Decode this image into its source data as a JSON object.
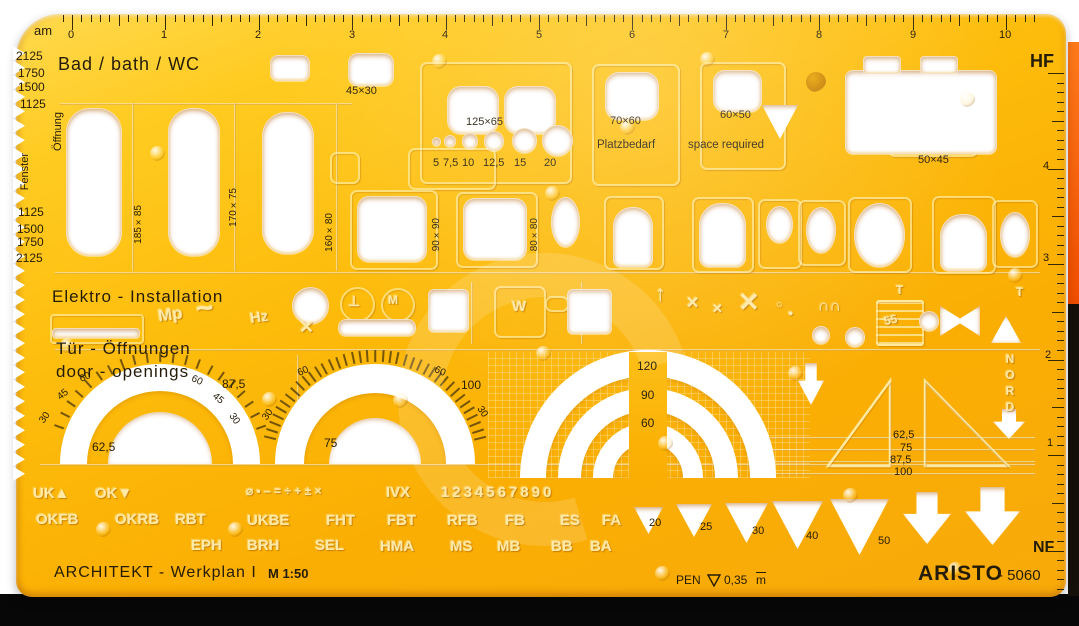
{
  "template": {
    "brand": "ARISTO",
    "model": "- 5060",
    "series_title": "ARCHITEKT - Werkplan I",
    "scale": "M 1:50",
    "pen_label": "PEN",
    "pen_size": "0,35",
    "pen_unit": "m",
    "corner_top_left": "am",
    "corner_top_right": "HF",
    "corner_bottom_right": "NF"
  },
  "top_ruler": {
    "numbers": [
      {
        "t": "0",
        "x": 68,
        "y": 30
      },
      {
        "t": "1",
        "x": 161,
        "y": 30
      },
      {
        "t": "2",
        "x": 255,
        "y": 30
      },
      {
        "t": "3",
        "x": 349,
        "y": 30
      },
      {
        "t": "4",
        "x": 442,
        "y": 30
      },
      {
        "t": "5",
        "x": 536,
        "y": 30
      },
      {
        "t": "6",
        "x": 629,
        "y": 30
      },
      {
        "t": "7",
        "x": 723,
        "y": 30
      },
      {
        "t": "8",
        "x": 816,
        "y": 30
      },
      {
        "t": "9",
        "x": 910,
        "y": 30
      },
      {
        "t": "10",
        "x": 999,
        "y": 30
      }
    ]
  },
  "right_ruler": {
    "numbers": [
      {
        "t": "4",
        "x": 1043,
        "y": 161
      },
      {
        "t": "3",
        "x": 1043,
        "y": 253
      },
      {
        "t": "2",
        "x": 1045,
        "y": 350
      },
      {
        "t": "1",
        "x": 1047,
        "y": 438
      }
    ]
  },
  "left_edge": {
    "values": [
      {
        "t": "2125",
        "x": 16,
        "y": 50,
        "s": 12
      },
      {
        "t": "1750",
        "x": 18,
        "y": 67,
        "s": 12
      },
      {
        "t": "1500",
        "x": 18,
        "y": 81,
        "s": 12
      },
      {
        "t": "1125",
        "x": 20,
        "y": 98,
        "s": 12
      },
      {
        "t": "1125",
        "x": 18,
        "y": 206,
        "s": 12
      },
      {
        "t": "1500",
        "x": 17,
        "y": 223,
        "s": 12
      },
      {
        "t": "1750",
        "x": 17,
        "y": 236,
        "s": 12
      },
      {
        "t": "2125",
        "x": 16,
        "y": 252,
        "s": 12
      }
    ],
    "window_labels": [
      {
        "t": "Öffnung",
        "x": 53,
        "y": 112,
        "s": 11,
        "vert": true,
        "n": "window-opening-label-de"
      },
      {
        "t": "Fenster",
        "x": 20,
        "y": 153,
        "s": 11,
        "vert": true,
        "n": "window-label-de"
      }
    ]
  },
  "printed_labels": [
    {
      "t": "am",
      "x": 34,
      "y": 24,
      "s": 13,
      "n": "corner-label-am"
    },
    {
      "t": "HF",
      "x": 1030,
      "y": 52,
      "s": 18,
      "b": true,
      "n": "corner-label-hf"
    },
    {
      "t": "NF",
      "x": 1033,
      "y": 540,
      "s": 16,
      "b": true,
      "n": "corner-label-nf"
    },
    {
      "t": "Bad / bath / WC",
      "x": 58,
      "y": 55,
      "s": 18,
      "ls": 1,
      "n": "section-title-bath"
    },
    {
      "t": "45×30",
      "x": 346,
      "y": 86,
      "s": 11
    },
    {
      "t": "125×65",
      "x": 466,
      "y": 117,
      "s": 11
    },
    {
      "t": "5",
      "x": 433,
      "y": 158,
      "s": 11
    },
    {
      "t": "7,5",
      "x": 443,
      "y": 158,
      "s": 11
    },
    {
      "t": "10",
      "x": 462,
      "y": 158,
      "s": 11
    },
    {
      "t": "12,5",
      "x": 483,
      "y": 158,
      "s": 11
    },
    {
      "t": "15",
      "x": 514,
      "y": 158,
      "s": 11
    },
    {
      "t": "20",
      "x": 544,
      "y": 158,
      "s": 11
    },
    {
      "t": "70×60",
      "x": 610,
      "y": 116,
      "s": 11
    },
    {
      "t": "60×50",
      "x": 720,
      "y": 110,
      "s": 11
    },
    {
      "t": "Platzbedarf",
      "x": 597,
      "y": 139,
      "s": 11.5
    },
    {
      "t": "space required",
      "x": 688,
      "y": 139,
      "s": 11.5
    },
    {
      "t": "50×45",
      "x": 918,
      "y": 155,
      "s": 11
    },
    {
      "t": "185×85",
      "x": 134,
      "y": 205,
      "s": 10,
      "vert": true
    },
    {
      "t": "170×75",
      "x": 229,
      "y": 188,
      "s": 10,
      "vert": true
    },
    {
      "t": "160×80",
      "x": 325,
      "y": 213,
      "s": 10,
      "vert": true
    },
    {
      "t": "90×90",
      "x": 432,
      "y": 218,
      "s": 10,
      "vert": true
    },
    {
      "t": "80×80",
      "x": 530,
      "y": 218,
      "s": 10,
      "vert": true
    },
    {
      "t": "Elektro - Installation",
      "x": 52,
      "y": 288,
      "s": 17,
      "ls": 1,
      "n": "section-title-elektro"
    },
    {
      "t": "Tür - Öffnungen",
      "x": 56,
      "y": 340,
      "s": 17,
      "ls": 1,
      "n": "section-title-doors-de"
    },
    {
      "t": "door - openings",
      "x": 56,
      "y": 363,
      "s": 17,
      "ls": 1,
      "n": "section-title-doors-en"
    },
    {
      "t": "30",
      "x": 40,
      "y": 413,
      "s": 10,
      "rot": -55
    },
    {
      "t": "45",
      "x": 58,
      "y": 390,
      "s": 10,
      "rot": -40
    },
    {
      "t": "60",
      "x": 80,
      "y": 373,
      "s": 10,
      "rot": -25
    },
    {
      "t": "60",
      "x": 191,
      "y": 376,
      "s": 10,
      "rot": 25
    },
    {
      "t": "45",
      "x": 212,
      "y": 394,
      "s": 10,
      "rot": 40
    },
    {
      "t": "30",
      "x": 228,
      "y": 414,
      "s": 10,
      "rot": 55
    },
    {
      "t": "62,5",
      "x": 92,
      "y": 441,
      "s": 12
    },
    {
      "t": "87,5",
      "x": 222,
      "y": 378,
      "s": 12
    },
    {
      "t": "30",
      "x": 263,
      "y": 410,
      "s": 10,
      "rot": -55
    },
    {
      "t": "60",
      "x": 298,
      "y": 367,
      "s": 10,
      "rot": -25
    },
    {
      "t": "75",
      "x": 324,
      "y": 437,
      "s": 12
    },
    {
      "t": "60",
      "x": 434,
      "y": 367,
      "s": 10,
      "rot": 25
    },
    {
      "t": "100",
      "x": 461,
      "y": 379,
      "s": 12
    },
    {
      "t": "30",
      "x": 476,
      "y": 407,
      "s": 10,
      "rot": 55
    },
    {
      "t": "120",
      "x": 637,
      "y": 360,
      "s": 12
    },
    {
      "t": "90",
      "x": 641,
      "y": 389,
      "s": 12
    },
    {
      "t": "60",
      "x": 641,
      "y": 417,
      "s": 12
    },
    {
      "t": "62,5",
      "x": 893,
      "y": 430,
      "s": 11
    },
    {
      "t": "75",
      "x": 900,
      "y": 443,
      "s": 11
    },
    {
      "t": "87,5",
      "x": 890,
      "y": 455,
      "s": 11
    },
    {
      "t": "100",
      "x": 894,
      "y": 467,
      "s": 11
    },
    {
      "t": "20",
      "x": 649,
      "y": 518,
      "s": 11
    },
    {
      "t": "25",
      "x": 700,
      "y": 522,
      "s": 11
    },
    {
      "t": "30",
      "x": 752,
      "y": 526,
      "s": 11
    },
    {
      "t": "40",
      "x": 806,
      "y": 531,
      "s": 11
    },
    {
      "t": "50",
      "x": 878,
      "y": 536,
      "s": 11
    },
    {
      "t": "ARCHITEKT - Werkplan I",
      "x": 54,
      "y": 565,
      "s": 16,
      "ls": 1,
      "n": "product-series"
    },
    {
      "t": "M 1:50",
      "x": 268,
      "y": 567,
      "s": 13,
      "b": true,
      "n": "product-scale"
    },
    {
      "t": "PEN",
      "x": 676,
      "y": 574,
      "s": 12,
      "n": "pen-label"
    },
    {
      "t": "0,35",
      "x": 724,
      "y": 574,
      "s": 12,
      "n": "pen-size"
    },
    {
      "t": "m",
      "x": 756,
      "y": 574,
      "s": 12,
      "cls": "overline",
      "n": "pen-unit"
    },
    {
      "t": "ARISTO",
      "x": 918,
      "y": 563,
      "s": 21,
      "b": true,
      "ls": 1,
      "n": "brand"
    },
    {
      "t": "- 5060",
      "x": 998,
      "y": 568,
      "s": 15,
      "n": "model"
    }
  ],
  "embossed_labels": [
    {
      "t": "Mp",
      "x": 158,
      "y": 306,
      "s": 17,
      "rot": -8
    },
    {
      "t": "~",
      "x": 196,
      "y": 294,
      "s": 30,
      "rot": -8
    },
    {
      "t": "Hz",
      "x": 250,
      "y": 310,
      "s": 15,
      "rot": -8
    },
    {
      "t": "⊥",
      "x": 348,
      "y": 294,
      "s": 14
    },
    {
      "t": "M",
      "x": 388,
      "y": 294,
      "s": 12
    },
    {
      "t": "W",
      "x": 512,
      "y": 299,
      "s": 15
    },
    {
      "t": "↑",
      "x": 655,
      "y": 283,
      "s": 22
    },
    {
      "t": "✕",
      "x": 686,
      "y": 296,
      "s": 16
    },
    {
      "t": "✕",
      "x": 712,
      "y": 302,
      "s": 13
    },
    {
      "t": "✕",
      "x": 738,
      "y": 289,
      "s": 26
    },
    {
      "t": "○",
      "x": 776,
      "y": 300,
      "s": 11
    },
    {
      "t": "●",
      "x": 788,
      "y": 309,
      "s": 9
    },
    {
      "t": "∩∩",
      "x": 818,
      "y": 299,
      "s": 16
    },
    {
      "t": "T",
      "x": 896,
      "y": 284,
      "s": 12
    },
    {
      "t": "55",
      "x": 884,
      "y": 314,
      "s": 12,
      "rot": -12
    },
    {
      "t": "T",
      "x": 1016,
      "y": 286,
      "s": 12
    },
    {
      "t": "NORD",
      "x": 1004,
      "y": 352,
      "s": 12,
      "vstack": true,
      "n": "north-label"
    },
    {
      "t": "UK▲",
      "x": 33,
      "y": 486,
      "s": 15
    },
    {
      "t": "OK▼",
      "x": 95,
      "y": 486,
      "s": 15
    },
    {
      "t": "⌀ ▪ ‒ = ÷ + ± ×",
      "x": 246,
      "y": 485,
      "s": 12
    },
    {
      "t": "IVX",
      "x": 386,
      "y": 485,
      "s": 15
    },
    {
      "t": "1234567890",
      "x": 441,
      "y": 485,
      "s": 15,
      "ls": 3
    },
    {
      "t": "OKFB",
      "x": 36,
      "y": 512,
      "s": 15
    },
    {
      "t": "OKRB",
      "x": 115,
      "y": 512,
      "s": 15
    },
    {
      "t": "RBT",
      "x": 175,
      "y": 512,
      "s": 15
    },
    {
      "t": "UKBE",
      "x": 247,
      "y": 513,
      "s": 15
    },
    {
      "t": "FHT",
      "x": 326,
      "y": 513,
      "s": 15
    },
    {
      "t": "FBT",
      "x": 387,
      "y": 513,
      "s": 15
    },
    {
      "t": "RFB",
      "x": 447,
      "y": 513,
      "s": 15
    },
    {
      "t": "FB",
      "x": 505,
      "y": 513,
      "s": 15
    },
    {
      "t": "ES",
      "x": 560,
      "y": 513,
      "s": 15
    },
    {
      "t": "FA",
      "x": 602,
      "y": 513,
      "s": 15
    },
    {
      "t": "EPH",
      "x": 191,
      "y": 538,
      "s": 15
    },
    {
      "t": "BRH",
      "x": 247,
      "y": 538,
      "s": 15
    },
    {
      "t": "SEL",
      "x": 315,
      "y": 538,
      "s": 15
    },
    {
      "t": "HMA",
      "x": 380,
      "y": 539,
      "s": 15
    },
    {
      "t": "MS",
      "x": 450,
      "y": 539,
      "s": 15
    },
    {
      "t": "MB",
      "x": 497,
      "y": 539,
      "s": 15
    },
    {
      "t": "BB",
      "x": 551,
      "y": 539,
      "s": 15
    },
    {
      "t": "BA",
      "x": 590,
      "y": 539,
      "s": 15
    }
  ]
}
